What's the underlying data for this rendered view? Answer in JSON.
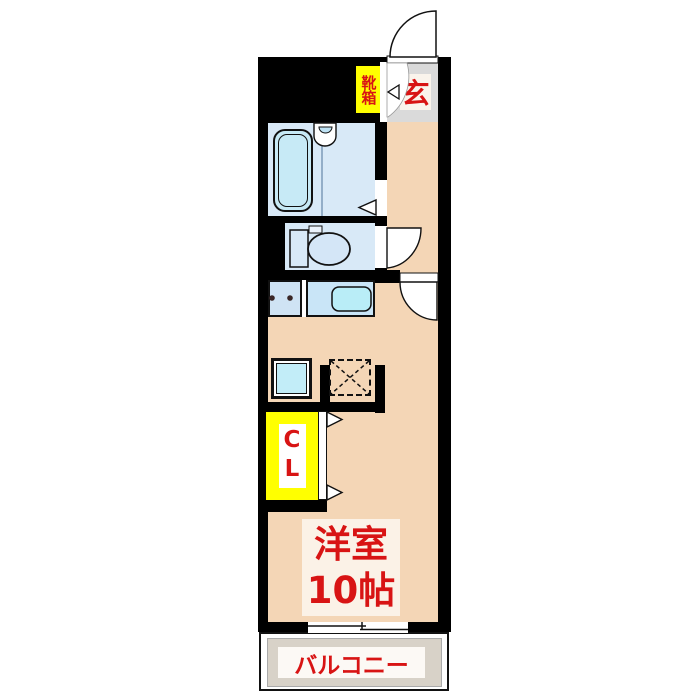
{
  "floorplan": {
    "entrance": {
      "label": "玄"
    },
    "shoe_cabinet": {
      "label": "靴箱"
    },
    "closet": {
      "label": "CL"
    },
    "main_room": {
      "name": "洋室",
      "size": "10帖"
    },
    "balcony": {
      "label": "バルコニー"
    },
    "fixtures": [
      "bathtub",
      "bathroom-sink",
      "toilet",
      "kitchen-sink",
      "2-burner-stove",
      "washing-machine-space",
      "refrigerator-space",
      "entrance-door",
      "toilet-door",
      "room-door",
      "closet-door",
      "sliding-window"
    ],
    "colors": {
      "wall": "#000000",
      "floor_pink": "#F4D6B6",
      "wet_area_blue": "#D8E9F7",
      "fixture_cyan": "#BFEAF6",
      "entrance_gray": "#DADADA",
      "balcony_gray": "#D8D2C8",
      "highlight_yellow": "#FFFF00",
      "text_red": "#D81414"
    }
  }
}
